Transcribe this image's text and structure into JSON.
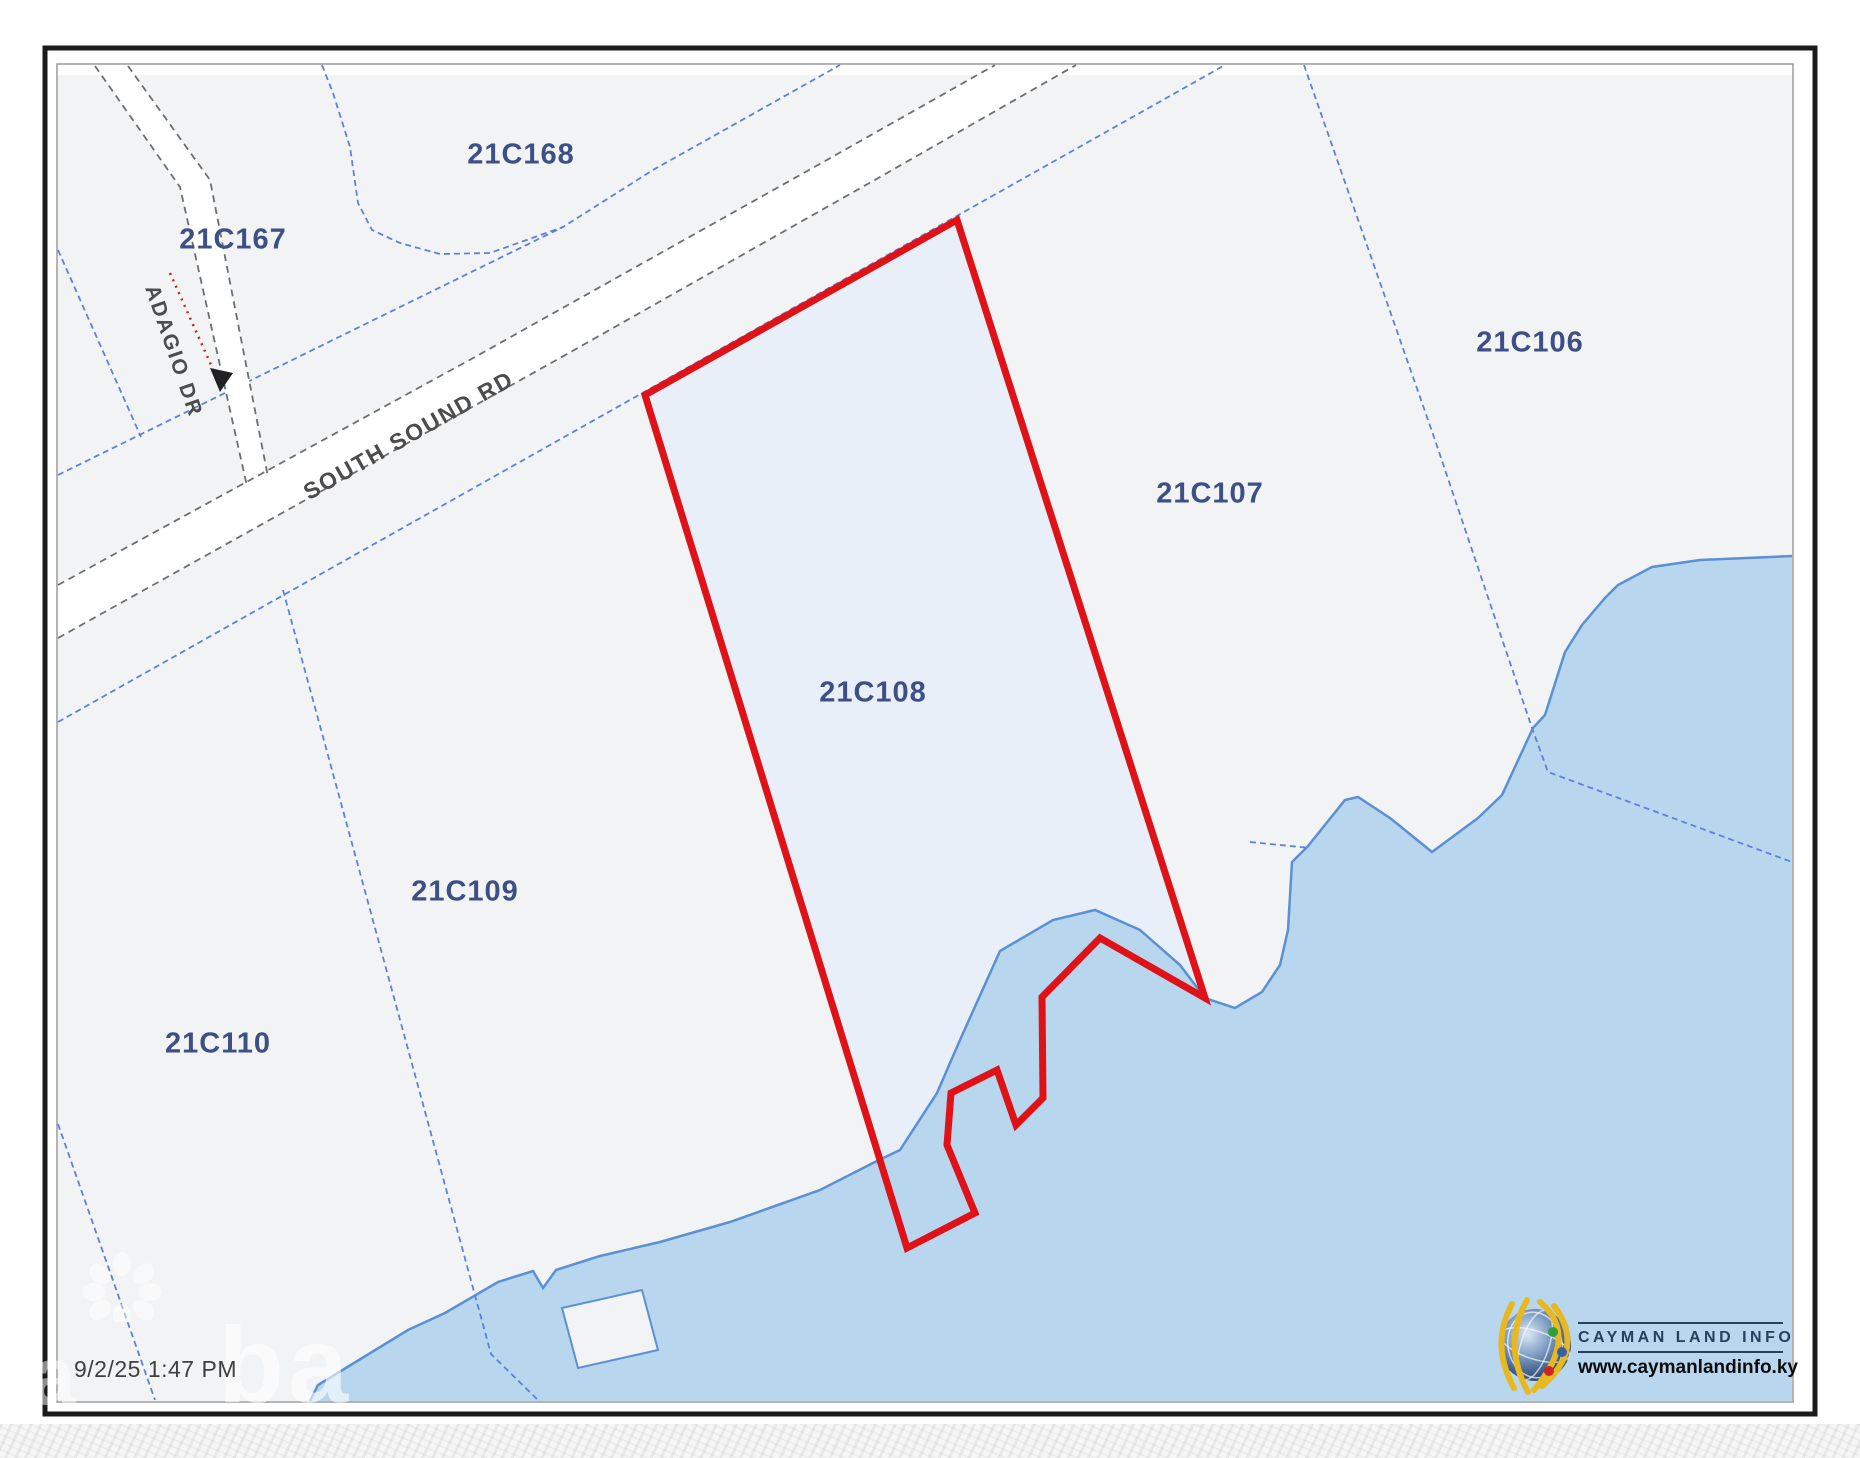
{
  "map": {
    "parcels": [
      {
        "label": "21C167"
      },
      {
        "label": "21C168"
      },
      {
        "label": "21C106"
      },
      {
        "label": "21C107"
      },
      {
        "label": "21C108",
        "selected": true
      },
      {
        "label": "21C109"
      },
      {
        "label": "21C110"
      }
    ],
    "roads": [
      {
        "name": "SOUTH SOUND RD"
      },
      {
        "name": "ADAGIO DR"
      }
    ],
    "timestamp": "9/2/25 1:47 PM",
    "watermark_text": "ba",
    "watermark_text_left": "a"
  },
  "branding": {
    "name": "CAYMAN LAND INFO",
    "url": "www.caymanlandinfo.ky"
  },
  "theme": {
    "water_fill": "#b9d6ef",
    "shoreline_stroke": "#5b90d2",
    "parcel_line_blue": "#5d82d6",
    "selected_parcel_outline": "#df1217",
    "selected_parcel_fill": "#e9eff8",
    "land_background": "#f2f3f5",
    "road_fill": "#ffffff",
    "road_edge_gray": "#6e6e6e",
    "parcel_label_color": "#3d5086",
    "road_label_color": "#4c4c4c",
    "brand_navy": "#24415f",
    "frame_black": "#1b1b1b"
  }
}
